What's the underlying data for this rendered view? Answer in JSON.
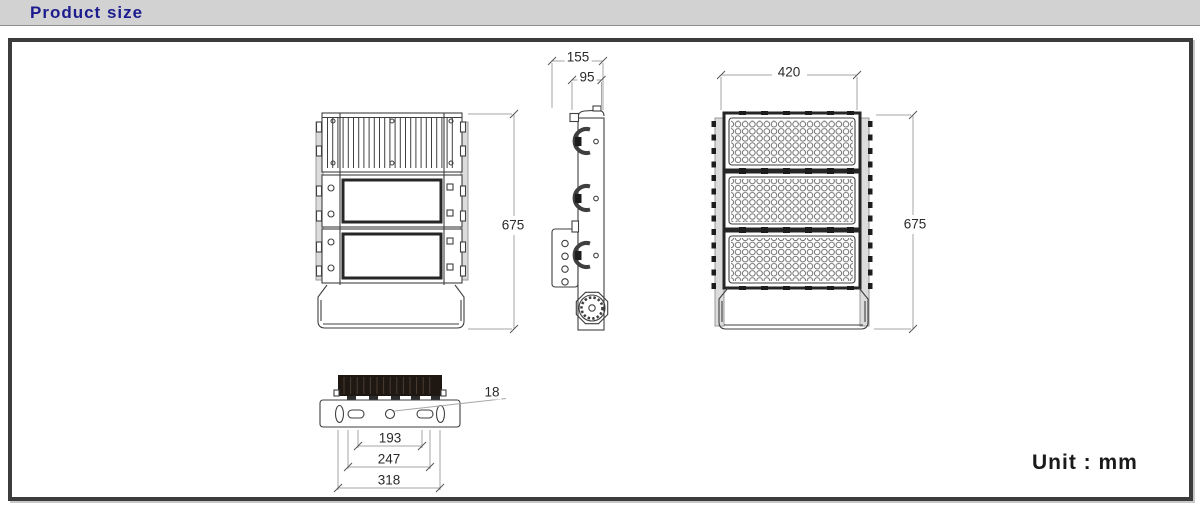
{
  "header": {
    "title": "Product size"
  },
  "unit": {
    "label": "Unit : mm"
  },
  "dimensions": {
    "side_total_width": "155",
    "side_body_width": "95",
    "front_width": "420",
    "back_height": "675",
    "front_height": "675",
    "mount_hole_diameter": "18",
    "mount_slot_spacing": "193",
    "mount_slot_outer_spacing": "247",
    "bracket_total_width": "318"
  },
  "colors": {
    "title": "#1c1c8e",
    "band_bg": "#d2d2d2",
    "line": "#3f3f3f",
    "dim_line": "#a6a6a6",
    "dim_text": "#2a2a2a",
    "heatsink_fill": "#1f1812",
    "border": "#3c3c3c"
  }
}
